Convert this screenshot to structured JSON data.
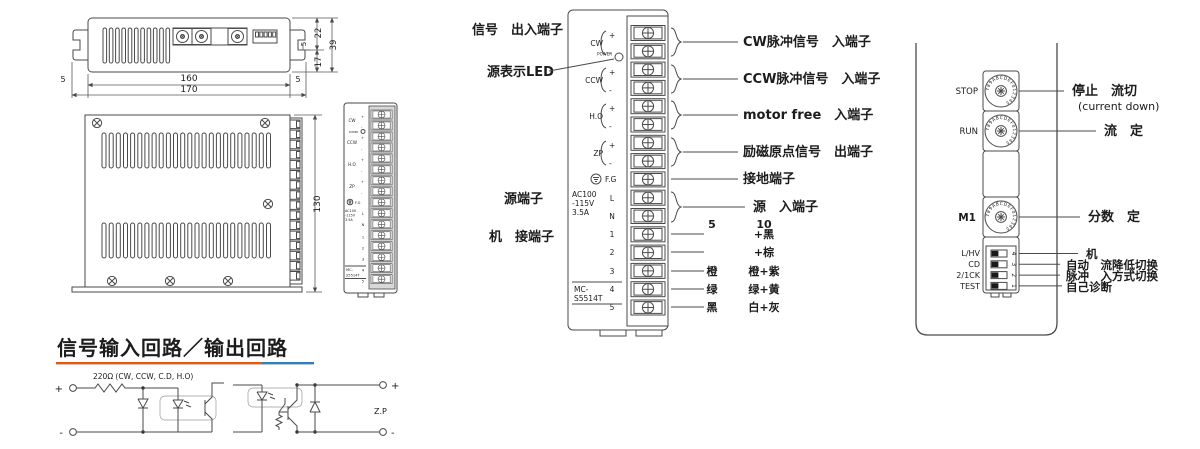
{
  "colors": {
    "accent_orange": "#e8560e",
    "accent_blue": "#2d7fc1",
    "line": "#4a4a4a"
  },
  "dims": {
    "len160": "160",
    "len170": "170",
    "left5": "5",
    "right5": "5",
    "h22": "22",
    "h39": "39",
    "h17": "17",
    "h5": "5",
    "height130": "130"
  },
  "panel": {
    "power_led_label": "POWER",
    "plus": "+",
    "minus": "-",
    "sig_cw": "CW",
    "sig_ccw": "CCW",
    "sig_ho": "H.O",
    "sig_zp": "ZP",
    "fg_label": "F.G",
    "ac_line1": "AC100",
    "ac_line2": "-115V",
    "ac_line3": "3.5A",
    "l_label": "L",
    "n_label": "N",
    "motor_terminals": [
      "1",
      "2",
      "3",
      "4",
      "5"
    ],
    "model_line1": "MC-",
    "model_line2": "S5514T"
  },
  "middle_labels": {
    "signal_io": "信号　出入端子",
    "power_led": "源表示LED",
    "power_terminal": "源端子",
    "motor_terminal": "机　接端子",
    "cw_input": "CW脉冲信号　入端子",
    "ccw_input": "CCW脉冲信号　入端子",
    "motor_free": "motor free　入端子",
    "zp_output": "励磁原点信号　出端子",
    "ground": "接地端子",
    "power_input": "源　入端子",
    "wire_col_5": "5",
    "wire_col_10": "10",
    "wire_rows": [
      {
        "c5": "",
        "c10": "+黑"
      },
      {
        "c5": "",
        "c10": "+棕"
      },
      {
        "c5": "橙",
        "c10": "橙+紫"
      },
      {
        "c5": "绿",
        "c10": "绿+黄"
      },
      {
        "c5": "黑",
        "c10": "白+灰"
      }
    ]
  },
  "right_panel": {
    "dial_letters": "789ABCDEF012345",
    "stop_label": "STOP",
    "run_label": "RUN",
    "m1_label": "M1",
    "stop_desc": "停止　流切",
    "stop_desc2": "(current down)",
    "run_desc": "流　定",
    "m1_desc": "分数　定",
    "dip_labels": [
      "L/HV",
      "CD",
      "2/1CK",
      "TEST"
    ],
    "dip_nums": [
      "4",
      "3",
      "2",
      "1"
    ],
    "dip_descs": [
      "机",
      "自动　流降低切换",
      "脉冲　入方式切换",
      "自己诊断"
    ]
  },
  "circuit": {
    "title": "信号输入回路／输出回路",
    "resistor_label": "220Ω (CW, CCW, C.D, H.O)",
    "zp": "Z.P",
    "plus": "+",
    "minus": "-"
  }
}
